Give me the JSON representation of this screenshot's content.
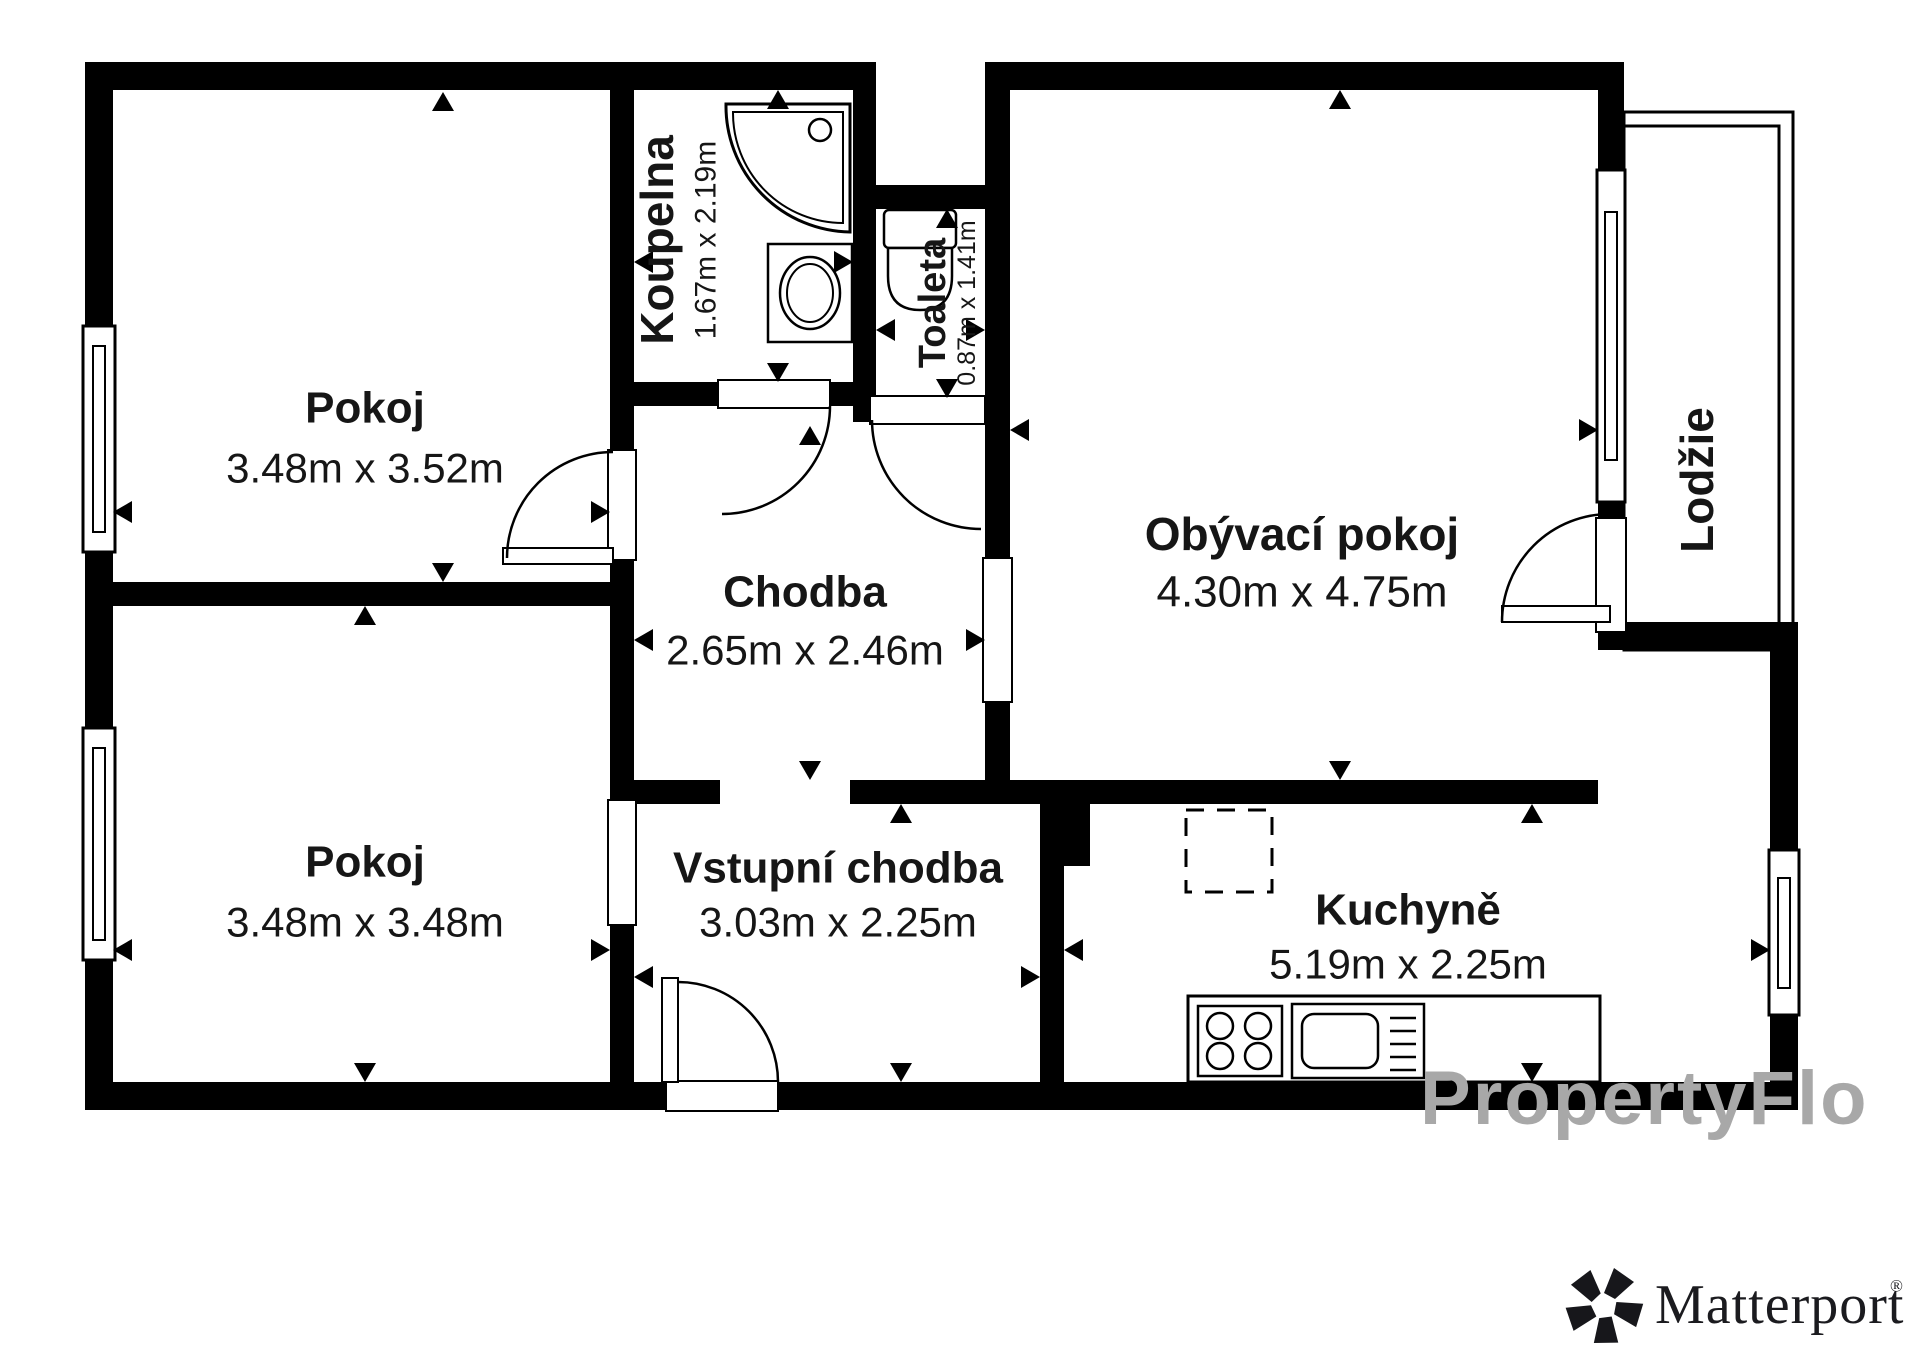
{
  "page": {
    "type": "floor-plan",
    "background": "#ffffff"
  },
  "colors": {
    "wall": "#000000",
    "text": "#161616",
    "watermark": "#a8a8a8",
    "logo": "#1b1b1f"
  },
  "rooms": [
    {
      "id": "pokoj-1",
      "name": "Pokoj",
      "dims": "3.48m x 3.52m"
    },
    {
      "id": "pokoj-2",
      "name": "Pokoj",
      "dims": "3.48m x 3.48m"
    },
    {
      "id": "koupelna",
      "name": "Koupelna",
      "dims": "1.67m x 2.19m"
    },
    {
      "id": "toaleta",
      "name": "Toaleta",
      "dims": "0.87m x 1.41m"
    },
    {
      "id": "chodba",
      "name": "Chodba",
      "dims": "2.65m x 2.46m"
    },
    {
      "id": "vstupni-chodba",
      "name": "Vstupní chodba",
      "dims": "3.03m x 2.25m"
    },
    {
      "id": "obyvaci-pokoj",
      "name": "Obývací pokoj",
      "dims": "4.30m x 4.75m"
    },
    {
      "id": "kuchyne",
      "name": "Kuchyně",
      "dims": "5.19m x 2.25m"
    },
    {
      "id": "lodzie",
      "name": "Lodžie",
      "dims": ""
    }
  ],
  "watermark": "PropertyFlo",
  "logo": {
    "brand": "Matterport",
    "registered": "®"
  },
  "icons": {
    "matterport_mark": "pinwheel-pentagon"
  }
}
